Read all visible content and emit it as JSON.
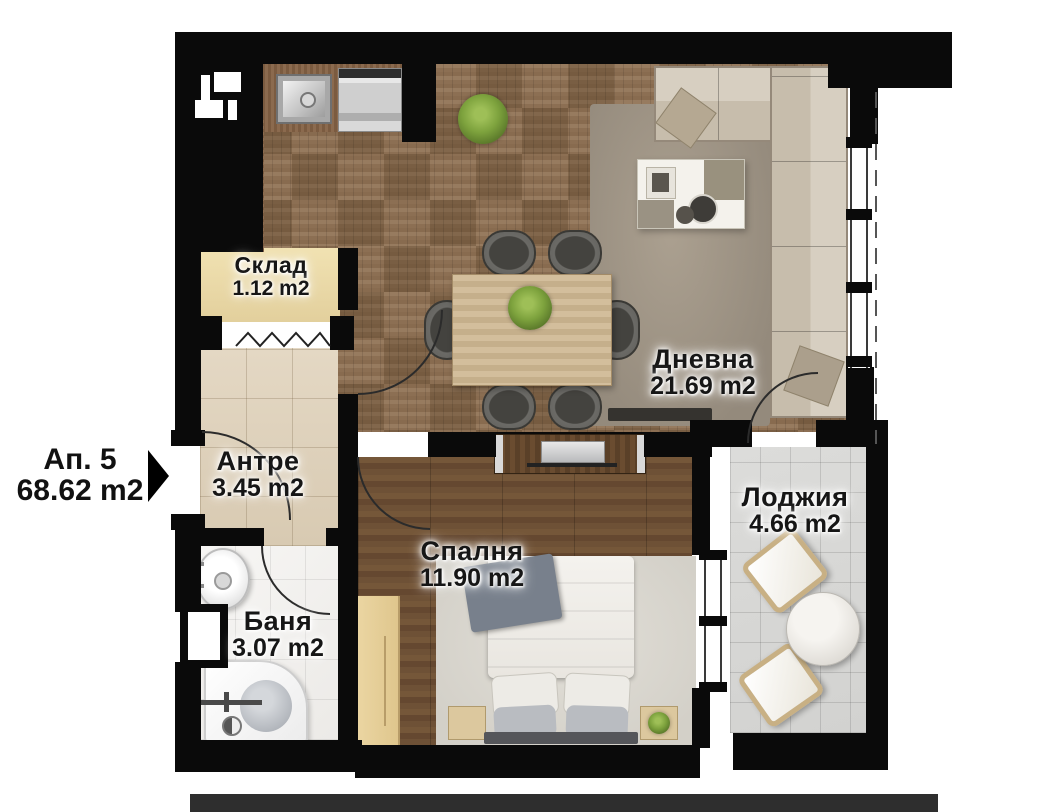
{
  "apartment": {
    "name": "Ап. 5",
    "area": "68.62 m2"
  },
  "rooms": {
    "storage": {
      "name": "Склад",
      "area": "1.12 m2"
    },
    "living": {
      "name": "Дневна",
      "area": "21.69 m2"
    },
    "hallway": {
      "name": "Антре",
      "area": "3.45 m2"
    },
    "loggia": {
      "name": "Лоджия",
      "area": "4.66 m2"
    },
    "bedroom": {
      "name": "Спалня",
      "area": "11.90 m2"
    },
    "bathroom": {
      "name": "Баня",
      "area": "3.07 m2"
    }
  },
  "colors": {
    "wall": "#0a0a0a",
    "parquet": "#8c6f53",
    "bedroom_floor": "#6a4d33",
    "hallway_floor": "#ddd0bb",
    "storage_floor": "#ecd9a6",
    "bathroom_floor": "#f5f4f2",
    "loggia_floor": "#d9d9d7",
    "burner_accent": "#e02b1d",
    "plant_green": "#7da23d"
  },
  "furniture": {
    "kitchen": [
      "counter",
      "sink",
      "dishwasher",
      "cooktop"
    ],
    "living": [
      "corner-sofa",
      "rug",
      "coffee-table",
      "dining-table",
      "six-chairs",
      "plant",
      "tv"
    ],
    "bedroom": [
      "double-bed",
      "nightstand-left",
      "nightstand-right",
      "wardrobe",
      "tv-unit",
      "rug"
    ],
    "bathroom": [
      "washbasin",
      "shower"
    ],
    "loggia": [
      "armchair-top",
      "armchair-bottom",
      "round-table"
    ]
  }
}
